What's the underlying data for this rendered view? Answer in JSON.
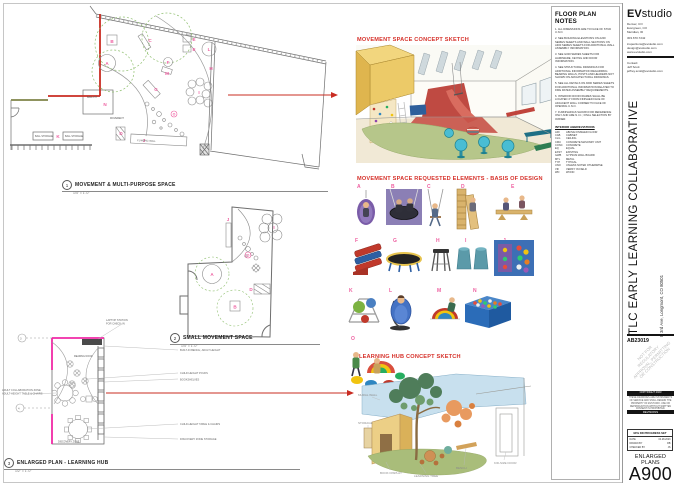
{
  "sheet": {
    "title_vertical": "TLC EARLY LEARNING COLLABORATIVE",
    "address_vertical": "E 3rd Ave, Longmont, CO 80501",
    "project_number": "AB23019",
    "watermark_l1": "NOT FOR",
    "watermark_l2": "REGULATORY",
    "watermark_l3": "APPROVAL, PERMITTING",
    "watermark_l4": "OR CONSTRUCTION"
  },
  "firm": {
    "logo_bold": "EV",
    "logo_rest": "studio",
    "office_1": "Denver, CO",
    "office_2": "Evergreen, CO",
    "office_3": "Meridian, ID",
    "phone": "303.670.7242",
    "link_1": "inspections@evstudio.com",
    "link_2": "design@evstudio.com",
    "link_3": "www.evstudio.com",
    "contact_label": "Contact:",
    "contact_name": "Jeff Scott",
    "contact_email": "jeffrey.scott@evstudio.com"
  },
  "notes_panel": {
    "title": "FLOOR PLAN NOTES",
    "notes": [
      "1.  ALL DIMENSIONS ARE TO FACE OF STUD U.N.O.",
      "2.  SEE BUILDING ELEVATIONS ON A200 SERIES SHEETS AND WALL SECTIONS ON A300 SERIES SHEETS FOR ADDITIONAL WALL ASSEMBLY INFORMATION.",
      "3.  SEE G000 SERIES SHEETS FOR HARDWARE, KEYING AND DOOR INFORMATION.",
      "4.  SEE STRUCTURAL DRAWINGS FOR ADDITIONAL INFORMATION REGARDING BEARING WALLS, POSTS AND HEADERS NOT SHOWN ON ARCHITECTURAL DRAWINGS.",
      "5.  SEE ALL DETAILS ON A500 SERIES SHEETS FOR ADDITIONAL INFORMATION RELATED TO FIRE RATED ASSEMBLY REQUIREMENTS.",
      "6.  INTERIOR DOOR FRAMES SHALL BE LOCATED 4\" FROM FINISHED FACE OF ADJACENT WALL CORNER TO FACE OF OPENING U.N.O.",
      "7.  FURNISHINGS SHOWN FOR REFERENCE ONLY AND ARE N.I.C.; FINAL SELECTION BY OWNER."
    ],
    "abbr_title": "INTERIOR ABBREVIATIONS",
    "abbreviations": [
      {
        "a": "AFF",
        "t": "ABOVE FINISHED FLOOR"
      },
      {
        "a": "CAB",
        "t": "CABINET"
      },
      {
        "a": "CLG",
        "t": "CEILING"
      },
      {
        "a": "CMU",
        "t": "CONCRETE MASONRY UNIT"
      },
      {
        "a": "CONC",
        "t": "CONCRETE"
      },
      {
        "a": "EQ",
        "t": "EQUAL"
      },
      {
        "a": "EXST",
        "t": "EXISTING"
      },
      {
        "a": "GWB",
        "t": "GYPSUM WALL BOARD"
      },
      {
        "a": "MTL",
        "t": "METAL"
      },
      {
        "a": "TYP",
        "t": "TYPICAL"
      },
      {
        "a": "UNO",
        "t": "UNLESS NOTED OTHERWISE"
      },
      {
        "a": "VIF",
        "t": "VERIFY IN FIELD"
      },
      {
        "a": "WD",
        "t": "WOOD"
      }
    ]
  },
  "plans": {
    "markers": {
      "a": "A",
      "b": "B",
      "c": "C",
      "d": "D",
      "e": "E",
      "f": "F",
      "g": "G",
      "h": "H",
      "i": "I",
      "j": "J",
      "k": "K",
      "l": "L",
      "m": "M",
      "n": "N",
      "o": "O"
    },
    "plan1": {
      "number": "1",
      "title": "MOVEMENT & MULTI-PURPOSE SPACE",
      "scale": "1/4\" = 1'-0\"",
      "labels": {
        "ball_pit": "BALL PIT",
        "ball_storage": "BALL STORAGE",
        "movement": "MOVEMENT",
        "climbing_wall": "CLIMBING WALL"
      }
    },
    "plan2": {
      "number": "2",
      "title": "SMALL MOVEMENT SPACE",
      "scale": "1/4\" = 1'-0\""
    },
    "plan3": {
      "number": "3",
      "title": "ENLARGED PLAN - LEARNING HUB",
      "scale": "1/2\" = 1'-0\"",
      "annotations": {
        "laptop1": "LAPTOP STATION",
        "laptop2": "FOR CHECK-IN",
        "bench": "BUILT-IN BENCH, ADULT HEIGHT",
        "poufs": "CHILD HEIGHT POUFS",
        "bookshelves": "BOOKSHELVES",
        "table": "CHILD-HEIGHT TABLE & CHAIRS",
        "storage": "DISCOVERY ZONE STORAGE",
        "adult1": "ADULT COLLABORATION ZONE",
        "adult2": "ADULT-HEIGHT TABLE & CHAIRS",
        "reading": "READING NOOK",
        "discovery": "DISCOVERY ZONE"
      },
      "grid_3": "3",
      "grid_4": "4"
    }
  },
  "sketches": {
    "movement_heading": "MOVEMENT SPACE CONCEPT SKETCH",
    "elements_heading": "MOVEMENT SPACE REQUESTED ELEMENTS - BASIS OF DESIGN",
    "learning_heading": "LEARNING HUB CONCEPT SKETCH",
    "learning_annotations": {
      "mural": "MURAL WALL",
      "storage": "STORAGE",
      "book": "BOOK DISPLAY",
      "tree": "LEARNING TREE",
      "bench": "BENCH",
      "door": "KID-SIZE DOOR"
    }
  },
  "elements": {
    "items": [
      {
        "letter": "A"
      },
      {
        "letter": "B"
      },
      {
        "letter": "C"
      },
      {
        "letter": "D"
      },
      {
        "letter": "E"
      },
      {
        "letter": "F"
      },
      {
        "letter": "G"
      },
      {
        "letter": "H"
      },
      {
        "letter": "I"
      },
      {
        "letter": "J"
      },
      {
        "letter": "K"
      },
      {
        "letter": "L"
      },
      {
        "letter": "M"
      },
      {
        "letter": "N"
      },
      {
        "letter": "O"
      }
    ]
  },
  "titleblock": {
    "copyright_bar": "COPYRIGHT 2023",
    "copyright_text": "THESE DRAWINGS ARE INSTRUMENTS OF SERVICE AND SHALL REMAIN THE PROPERTY OF EVSTUDIO. USE OR REPRODUCTION WITHOUT WRITTEN CONSENT IS PROHIBITED.",
    "revisions_label": "REVISIONS",
    "progress_title": "90% DD PROGRESS SET",
    "date_label": "DATE",
    "date_value": "04.28.2023",
    "drawn_label": "DRAWN BY",
    "drawn_value": "RB",
    "checked_label": "CHECKED BY",
    "checked_value": "JS",
    "sheet_title_1": "ENLARGED",
    "sheet_title_2": "PLANS",
    "sheet_number": "A900"
  }
}
